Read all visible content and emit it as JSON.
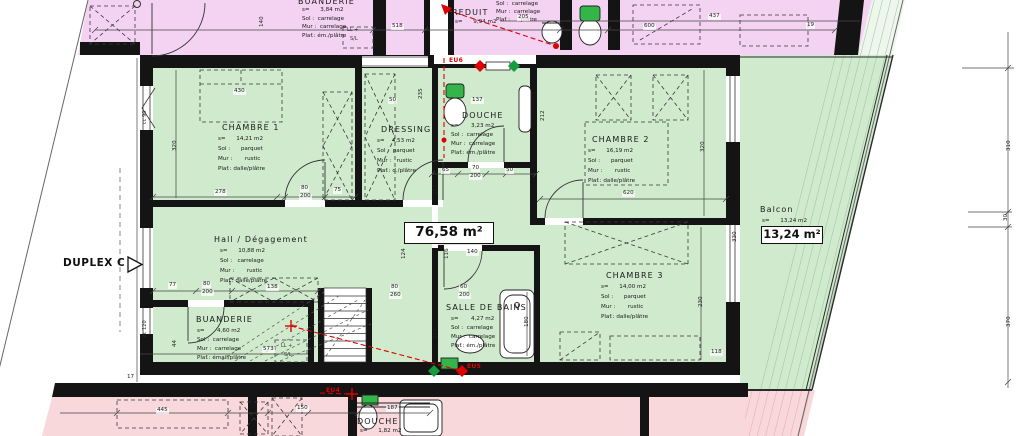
{
  "unit": {
    "duplex_label": "DUPLEX C",
    "area_total": "76,58 m²",
    "balcony_area": "13,24 m²"
  },
  "colors": {
    "upper_unit_fill": "#f4d2f2",
    "main_unit_fill": "#cfeacc",
    "lower_unit_fill": "#f8d8da",
    "wall": "#141414",
    "annotation_red": "#e00000",
    "appliance_green": "#33b54a"
  },
  "floorplan": {
    "rooms": [
      {
        "name": "CHAMBRE 1",
        "nx": 222,
        "ny": 124,
        "lx": 218,
        "ly": 137,
        "lh": 10,
        "lines": [
          "s=      14,21 m2",
          "Sol :      parquet",
          "Mur :       rustic",
          "Plaf.: dalle/plâtre"
        ]
      },
      {
        "name": "DRESSING",
        "nx": 381,
        "ny": 126,
        "lx": 377,
        "ly": 139,
        "lh": 10,
        "lines": [
          "s=    4,53 m2",
          "Sol :  parquet",
          "Mur :   rustic",
          "Plaf.: d./plâtre"
        ]
      },
      {
        "name": "DOUCHE",
        "nx": 462,
        "ny": 112,
        "lx": 451,
        "ly": 124,
        "lh": 9,
        "lines": [
          "s=       3,23 m2",
          "Sol :  carrelage",
          "Mur :  carrelage",
          "Plaf.: ém./plâtre"
        ]
      },
      {
        "name": "CHAMBRE 2",
        "nx": 592,
        "ny": 136,
        "lx": 588,
        "ly": 149,
        "lh": 10,
        "lines": [
          "s=      16,19 m2",
          "Sol :      parquet",
          "Mur :       rustic",
          "Plaf.: dalle/plâtre"
        ]
      },
      {
        "name": "Hall / Dégagement",
        "nx": 214,
        "ny": 236,
        "lx": 220,
        "ly": 249,
        "lh": 10,
        "lines": [
          "s=      10,88 m2",
          "Sol :   carrelage",
          "Mur :       rustic",
          "Plaf.: dalle/plâtre"
        ]
      },
      {
        "name": "CHAMBRE 3",
        "nx": 606,
        "ny": 272,
        "lx": 601,
        "ly": 285,
        "lh": 10,
        "lines": [
          "s=      14,00 m2",
          "Sol :      parquet",
          "Mur :       rustic",
          "Plaf.: dalle/plâtre"
        ]
      },
      {
        "name": "SALLE DE BAINS",
        "nx": 446,
        "ny": 304,
        "lx": 451,
        "ly": 317,
        "lh": 9,
        "lines": [
          "s=       4,27 m2",
          "Sol :  carrelage",
          "Mur :  carrelage",
          "Plaf.: ém./plâtre"
        ]
      },
      {
        "name": "BUANDERIE",
        "nx": 196,
        "ny": 316,
        "lx": 197,
        "ly": 329,
        "lh": 9,
        "lines": [
          "s=       4,60 m2",
          "Sol :  carrelage",
          "Mur :  carrelage",
          "Plaf.: émail/plâtre"
        ]
      },
      {
        "name": "Balcon",
        "nx": 760,
        "ny": 206,
        "lx": 762,
        "ly": 219,
        "lh": 9,
        "lines": [
          "s=      13,24 m2"
        ]
      },
      {
        "name": "BUANDERIE",
        "nx": 298,
        "ny": -2,
        "lx": 302,
        "ly": 8,
        "lh": 8.5,
        "lines": [
          "s=      3,84 m2",
          "Sol :  carrelage",
          "Mur :  carrelage",
          "Plaf.: ém./plâtre"
        ]
      },
      {
        "name": "REDUIT",
        "nx": 452,
        "ny": 9,
        "lx": 455,
        "ly": 20,
        "lh": 8.5,
        "lines": [
          "s=      9,94 m2"
        ]
      },
      {
        "name": "",
        "nx": 0,
        "ny": 0,
        "lx": 496,
        "ly": 2,
        "lh": 8,
        "lines": [
          "Sol :  carrelage",
          "Mur :  carrelage",
          "Plaf :      plâtre"
        ]
      },
      {
        "name": "DOUCHE",
        "nx": 357,
        "ny": 418,
        "lx": 360,
        "ly": 429,
        "lh": 8.5,
        "lines": [
          "s=      1,82 m2"
        ]
      }
    ],
    "dims": [
      {
        "t": "518",
        "x": 391,
        "y": 24
      },
      {
        "t": "205",
        "x": 517,
        "y": 15
      },
      {
        "t": "600",
        "x": 643,
        "y": 24
      },
      {
        "t": "437",
        "x": 708,
        "y": 14
      },
      {
        "t": "19",
        "x": 806,
        "y": 23
      },
      {
        "t": "140",
        "x": 260,
        "y": 28,
        "r": 1
      },
      {
        "t": "430",
        "x": 233,
        "y": 89
      },
      {
        "t": "50",
        "x": 388,
        "y": 98
      },
      {
        "t": "137",
        "x": 471,
        "y": 98
      },
      {
        "t": "235",
        "x": 419,
        "y": 100,
        "r": 1
      },
      {
        "t": "212",
        "x": 541,
        "y": 122,
        "r": 1
      },
      {
        "t": "320",
        "x": 173,
        "y": 152,
        "r": 1
      },
      {
        "t": "278",
        "x": 214,
        "y": 190
      },
      {
        "t": "80",
        "x": 300,
        "y": 186
      },
      {
        "t": "200",
        "x": 299,
        "y": 194
      },
      {
        "t": "75",
        "x": 333,
        "y": 188
      },
      {
        "t": "65",
        "x": 441,
        "y": 168
      },
      {
        "t": "70",
        "x": 471,
        "y": 166
      },
      {
        "t": "200",
        "x": 469,
        "y": 174
      },
      {
        "t": "50",
        "x": 505,
        "y": 168
      },
      {
        "t": "117",
        "x": 434,
        "y": 196,
        "r": 1
      },
      {
        "t": "620",
        "x": 622,
        "y": 191
      },
      {
        "t": "320",
        "x": 701,
        "y": 153,
        "r": 1
      },
      {
        "t": "330",
        "x": 733,
        "y": 243,
        "r": 1
      },
      {
        "t": "230",
        "x": 699,
        "y": 308,
        "r": 1
      },
      {
        "t": "118",
        "x": 710,
        "y": 350
      },
      {
        "t": "180",
        "x": 525,
        "y": 328,
        "r": 1
      },
      {
        "t": "207",
        "x": 434,
        "y": 340,
        "r": 1
      },
      {
        "t": "60",
        "x": 459,
        "y": 285
      },
      {
        "t": "200",
        "x": 458,
        "y": 293
      },
      {
        "t": "80",
        "x": 390,
        "y": 285
      },
      {
        "t": "260",
        "x": 389,
        "y": 293
      },
      {
        "t": "140",
        "x": 466,
        "y": 250
      },
      {
        "t": "116",
        "x": 445,
        "y": 260,
        "r": 1
      },
      {
        "t": "124",
        "x": 402,
        "y": 260,
        "r": 1
      },
      {
        "t": "138",
        "x": 266,
        "y": 285
      },
      {
        "t": "80",
        "x": 202,
        "y": 282
      },
      {
        "t": "200",
        "x": 201,
        "y": 290
      },
      {
        "t": "77",
        "x": 168,
        "y": 283
      },
      {
        "t": "573",
        "x": 262,
        "y": 347
      },
      {
        "t": "44",
        "x": 173,
        "y": 348,
        "r": 1
      },
      {
        "t": "445",
        "x": 156,
        "y": 408
      },
      {
        "t": "150",
        "x": 296,
        "y": 406
      },
      {
        "t": "187",
        "x": 386,
        "y": 406
      },
      {
        "t": "310",
        "x": 1007,
        "y": 152,
        "r": 1
      },
      {
        "t": "30",
        "x": 1004,
        "y": 222,
        "r": 1
      },
      {
        "t": "370",
        "x": 1007,
        "y": 328,
        "r": 1
      },
      {
        "t": "17",
        "x": 126,
        "y": 375
      },
      {
        "t": "cc 90",
        "x": 143,
        "y": 125,
        "r": 1,
        "c": "g"
      },
      {
        "t": "cc 120",
        "x": 143,
        "y": 338,
        "r": 1,
        "c": "g"
      },
      {
        "t": "LL +",
        "x": 346,
        "y": 28,
        "c": "g"
      },
      {
        "t": "S/L",
        "x": 349,
        "y": 37,
        "c": "g"
      },
      {
        "t": "LL +",
        "x": 280,
        "y": 344,
        "c": "g"
      },
      {
        "t": "S/L",
        "x": 283,
        "y": 353,
        "c": "g"
      }
    ],
    "eu_markers": [
      {
        "t": "EU6",
        "x": 448,
        "y": 58
      },
      {
        "t": "EU5",
        "x": 466,
        "y": 364
      },
      {
        "t": "EU4",
        "x": 325,
        "y": 388
      }
    ]
  }
}
